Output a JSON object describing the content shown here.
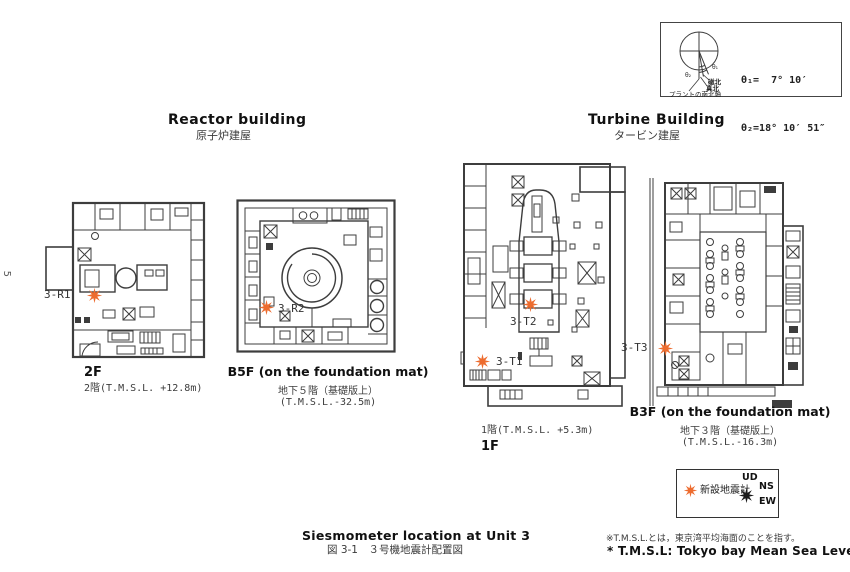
{
  "page": {
    "page_number": "5",
    "caption_en": "Siesmometer location at Unit 3",
    "caption_jp": "図 3-1　３号機地震計配置図",
    "note_jp": "※T.M.S.L.とは，東京湾平均海面のことを指す。",
    "note_en": "* T.M.S.L: Tokyo bay Mean Sea Level"
  },
  "north_reference": {
    "theta1_value": "θ₁=  7° 10′",
    "theta2_value": "θ₂=18° 10′ 51″",
    "theta1_label": "θ₁",
    "theta2_label": "θ₂",
    "magnetic_north": "磁北",
    "true_north": "真北",
    "plant_axis": "プラントの南北軸"
  },
  "buildings": {
    "reactor": {
      "title_en": "Reactor building",
      "title_jp": "原子炉建屋"
    },
    "turbine": {
      "title_en": "Turbine Building",
      "title_jp": "タービン建屋"
    }
  },
  "floors": {
    "reactor_2f": {
      "marker": "3-R1",
      "label_en": "2F",
      "label_jp": "2階(T.M.S.L. +12.8m)"
    },
    "reactor_b5f": {
      "marker": "3-R2",
      "label_en": "B5F (on the foundation mat)",
      "label_jp": "地下５階（基礎版上）",
      "elevation": "(T.M.S.L.-32.5m)"
    },
    "turbine_1f": {
      "marker_t2": "3-T2",
      "marker_t1": "3-T1",
      "label_jp": "1階(T.M.S.L. +5.3m)",
      "label_en": "1F"
    },
    "turbine_b3f": {
      "marker": "3-T3",
      "label_en": "B3F (on the foundation mat)",
      "label_jp": "地下３階（基礎版上）",
      "elevation": "(T.M.S.L.-16.3m)"
    }
  },
  "legend": {
    "new_seismometer": "新設地震計",
    "axis_ud": "UD",
    "axis_ns": "NS",
    "axis_ew": "EW"
  },
  "colors": {
    "marker_orange": "#ed6c2f",
    "star_black": "#1b1b1b",
    "line_dark": "#3d3d3d"
  }
}
